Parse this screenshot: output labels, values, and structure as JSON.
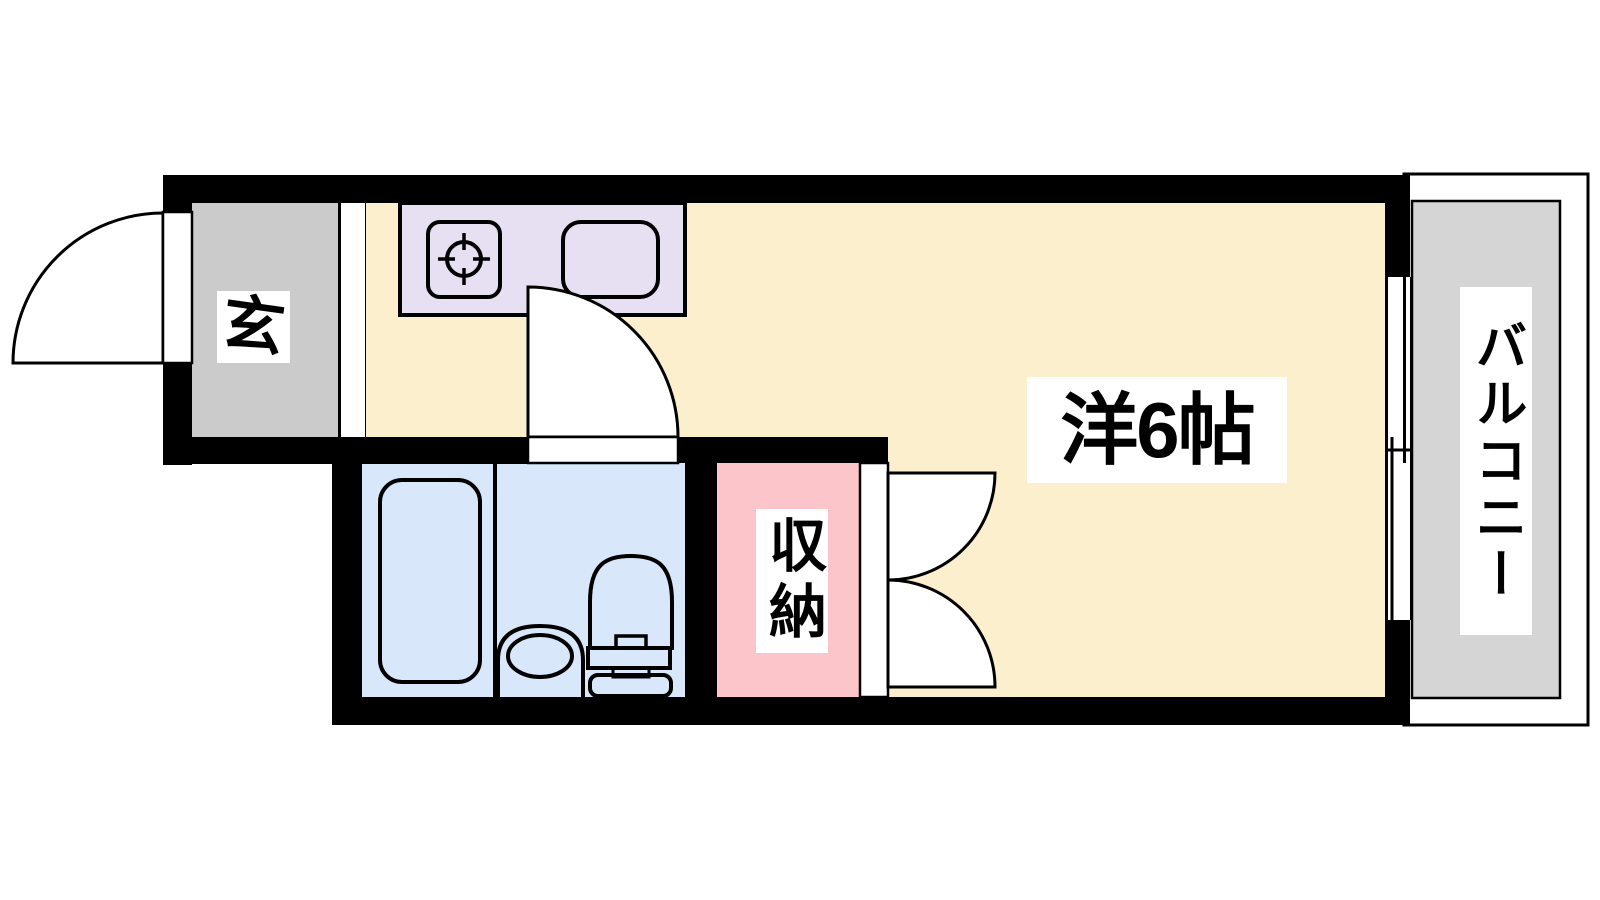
{
  "floorplan": {
    "background_color": "#ffffff",
    "wall_color": "#000000",
    "line_color": "#000000",
    "rooms": {
      "entrance": {
        "label": "玄",
        "color": "#cbcbcb"
      },
      "kitchen": {
        "color": "#e7dff2"
      },
      "living": {
        "label": "洋6帖",
        "color": "#fcefce"
      },
      "bathroom": {
        "color": "#d9e7fa"
      },
      "closet": {
        "label": "収納",
        "color": "#fbc5c9"
      },
      "balcony": {
        "label": "バルコニー",
        "color": "#d5d5d5"
      }
    }
  }
}
